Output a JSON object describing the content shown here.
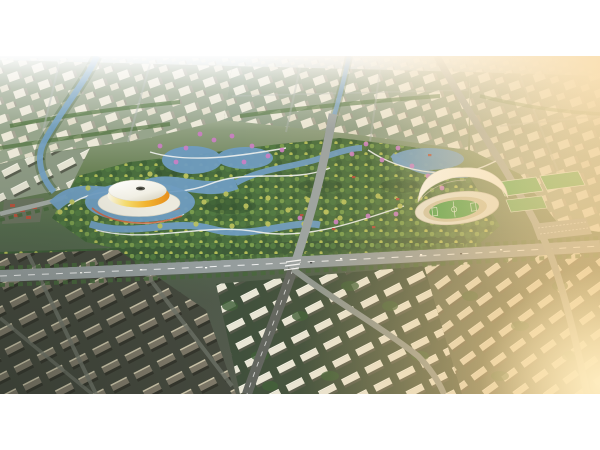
{
  "meta": {
    "type": "architectural-aerial-rendering",
    "description": "Bird's-eye masterplan rendering: a central riverside park with winding waterways links a yellow saucer-shaped arena on the left and a white shell-roofed stadium with athletics track and sports fields on the right; hazy city blocks fill the top, tree-lined avenues cross the middle, rows of residential slabs and towers fill the bottom, with warm sunlight glowing from the upper-right and lower-right."
  },
  "colors": {
    "letterbox": "#ffffff",
    "haze_white": "#ffffff",
    "horizon": "#c6d1d1",
    "city_base": "#97a58c",
    "building_cream": "#f0ecdc",
    "building_shadow": "#a8a595",
    "slab_white": "#f0ecdc",
    "slab_dark": "#837d6c",
    "tree_dark": "#3c5c38",
    "tree_mid": "#4e7340",
    "tree_light": "#86a050",
    "tree_yellow": "#bcc25e",
    "tree_pink": "#cd7fc6",
    "park_base": "#4a6e3e",
    "water": "#74a0c2",
    "water_deep": "#6f9cc0",
    "path_white": "#eef0ee",
    "road_grey": "#959d9d",
    "road_dark": "#61655f",
    "arena_yellow": "#f2b430",
    "arena_orange": "#e68e1c",
    "arena_platform": "#eceade",
    "arena_dome": "#ffffff",
    "stadium_roof": "#fafaf4",
    "track_tan": "#cdc4a4",
    "pitch_green": "#3f9b42",
    "field_green": "#46a44b",
    "pavilion_red": "#b0503c",
    "sun_glow": "#fff6dd",
    "gold_glow": "#f9d492"
  }
}
